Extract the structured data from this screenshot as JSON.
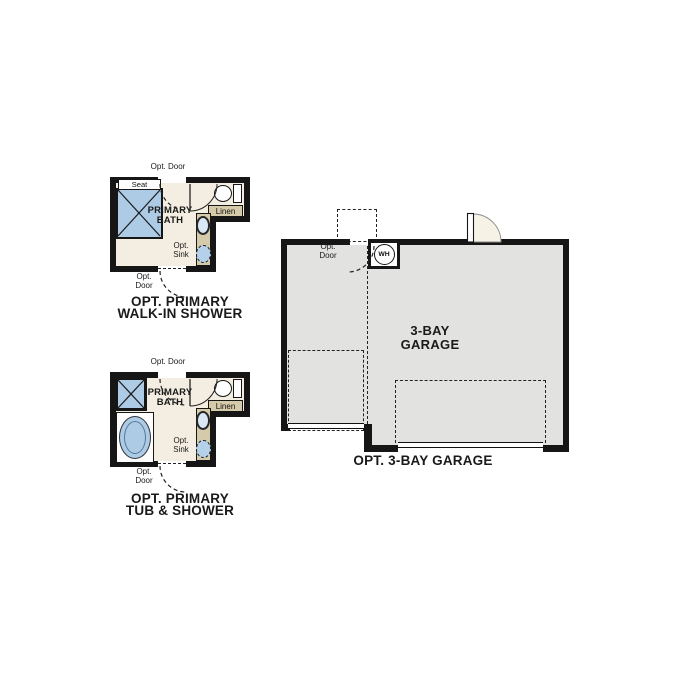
{
  "palette": {
    "wall": "#161616",
    "bathroom_floor": "#f3eee1",
    "garage_floor": "#e2e2e0",
    "fixture_blue": "#aecbe6",
    "cabinet_tan": "#d5caa9",
    "door_swing_fill": "#f7f2e6",
    "text": "#111111"
  },
  "plans": {
    "walk_in_shower": {
      "caption_line1": "OPT. PRIMARY",
      "caption_line2": "WALK-IN SHOWER",
      "room_line1": "PRIMARY",
      "room_line2": "BATH",
      "seat": "Seat",
      "linen": "Linen",
      "opt_door_top": "Opt. Door",
      "opt_abbr": "Opt.",
      "door_abbr": "Door",
      "sink_abbr": "Sink"
    },
    "tub_shower": {
      "caption_line1": "OPT. PRIMARY",
      "caption_line2": "TUB & SHOWER",
      "room_line1": "PRIMARY",
      "room_line2": "BATH",
      "linen": "Linen",
      "opt_door_top": "Opt. Door",
      "opt_abbr": "Opt.",
      "door_abbr": "Door",
      "sink_abbr": "Sink"
    },
    "garage": {
      "caption": "OPT. 3-BAY GARAGE",
      "room_line1": "3-BAY",
      "room_line2": "GARAGE",
      "water_heater": "WH",
      "opt_abbr": "Opt.",
      "door_abbr": "Door"
    }
  }
}
